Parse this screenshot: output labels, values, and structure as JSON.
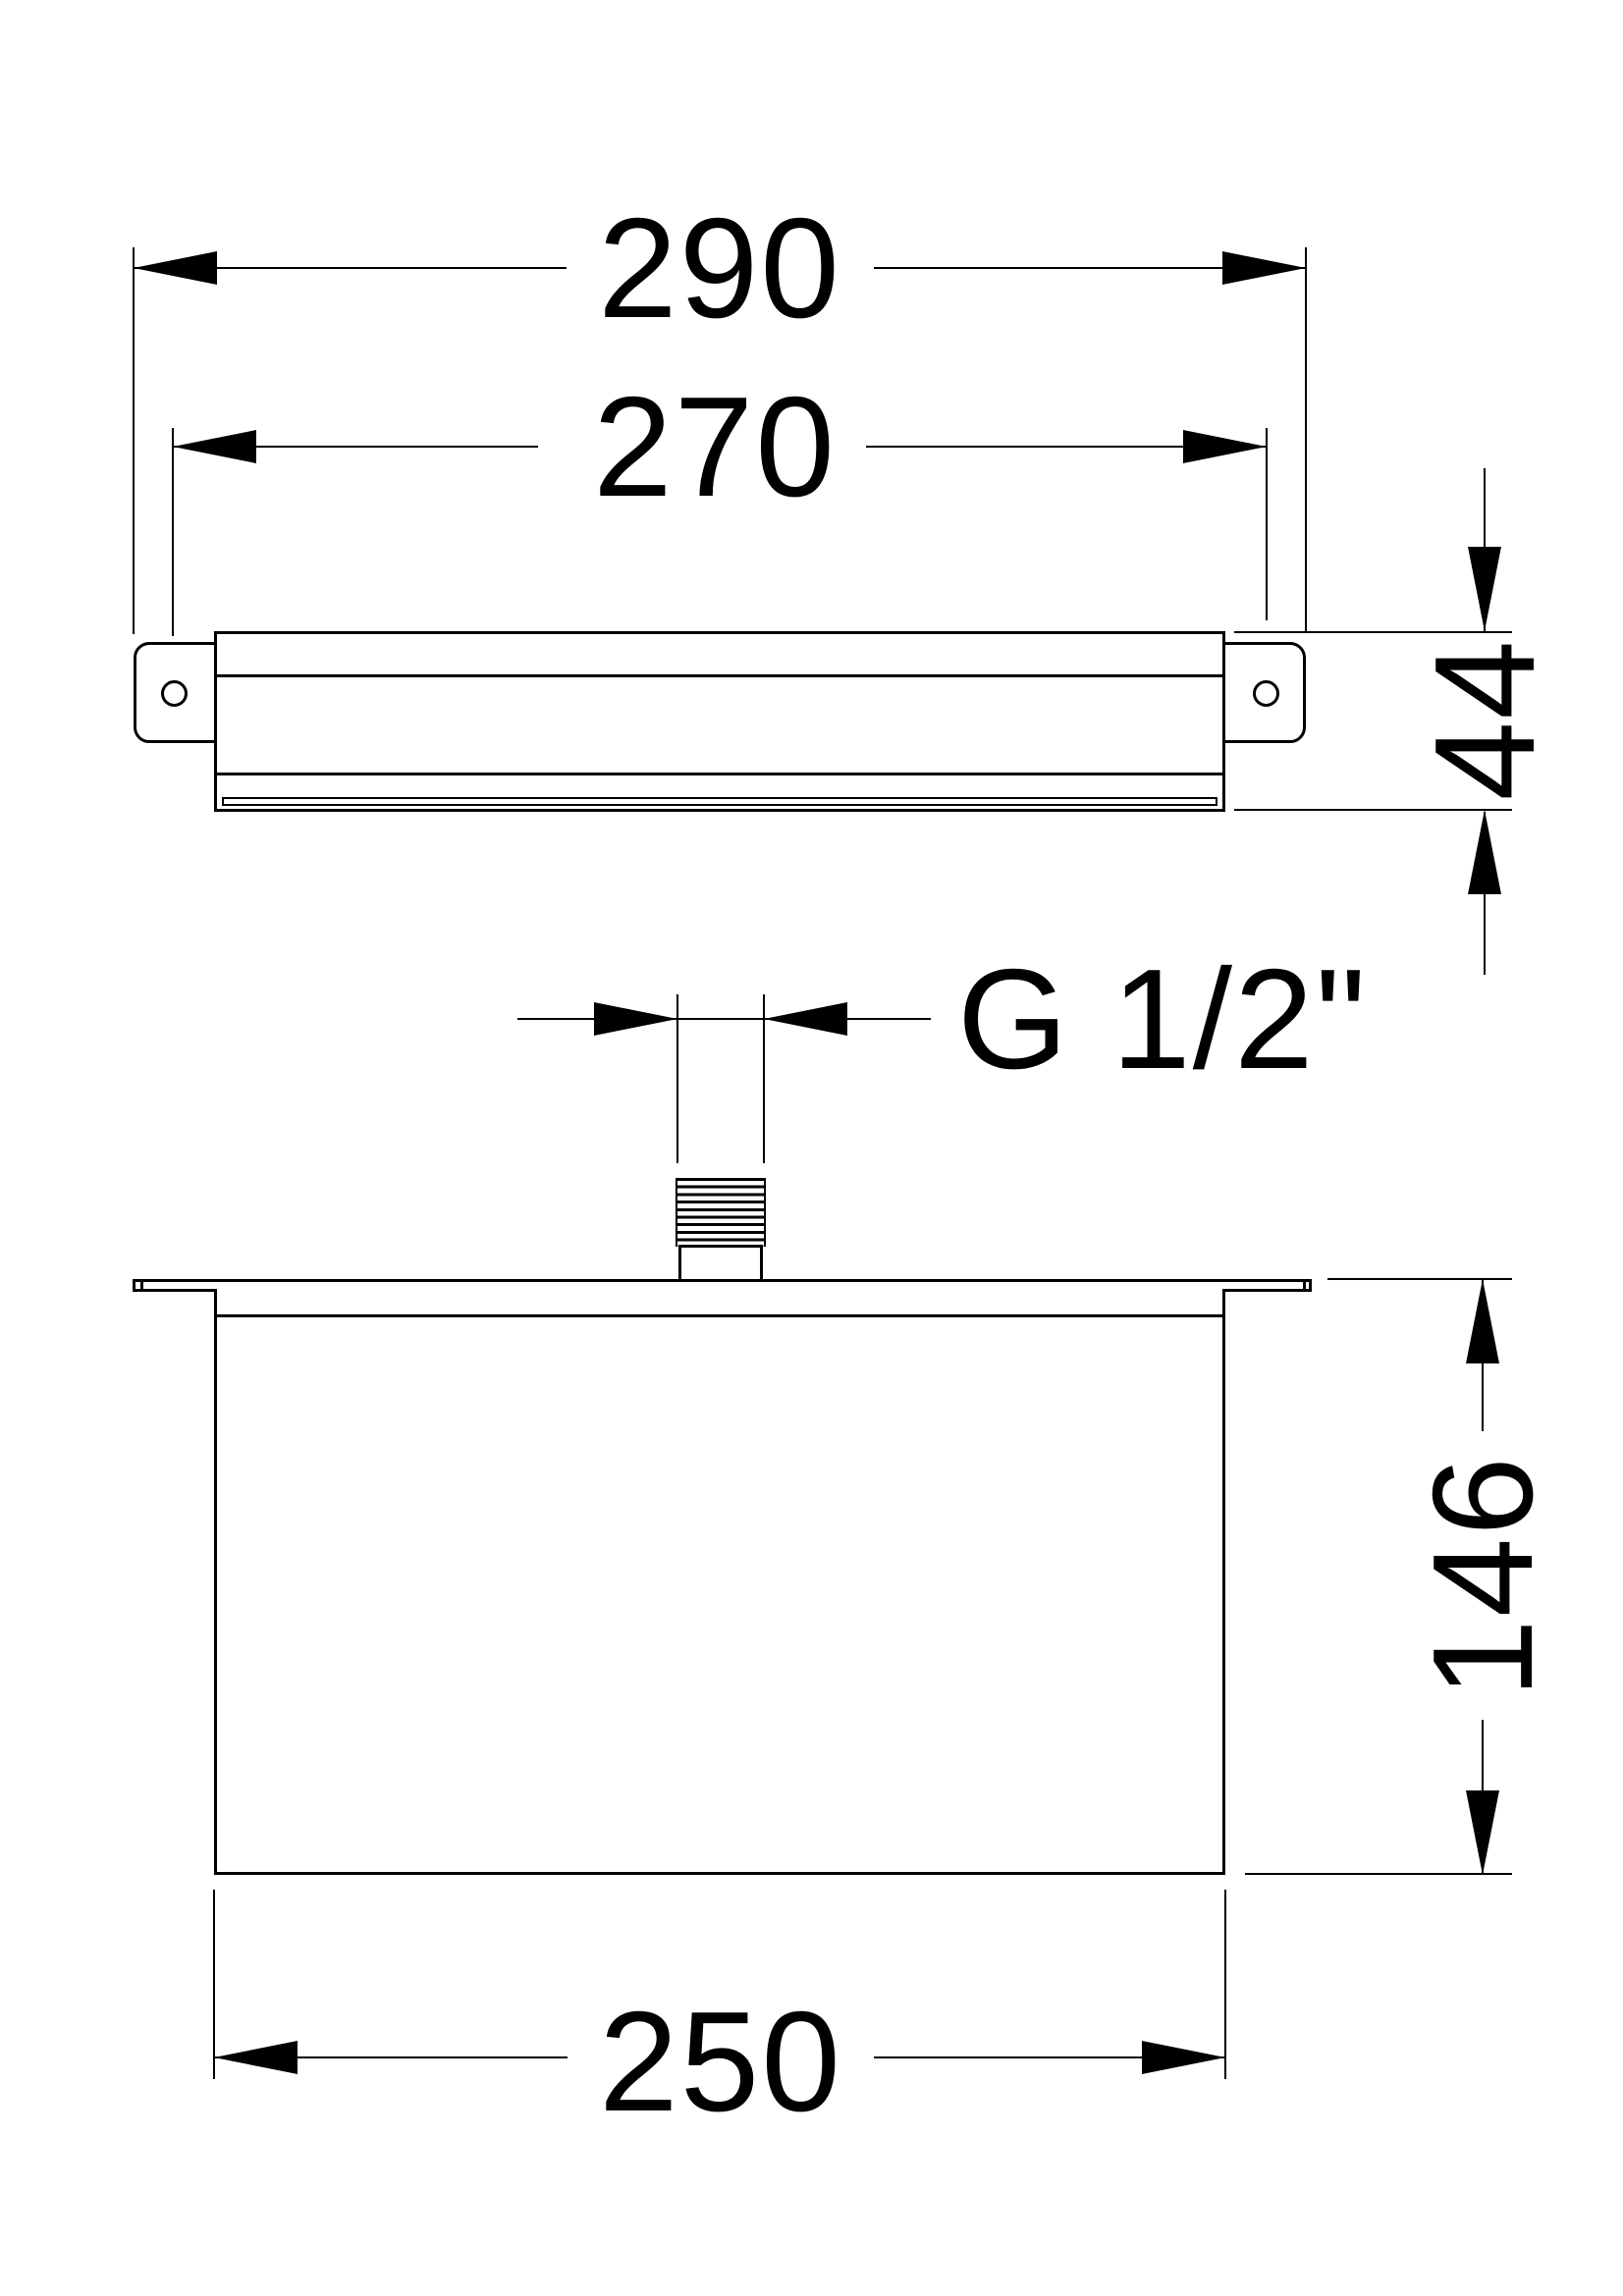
{
  "drawing": {
    "type": "technical-dimension-drawing",
    "background_color": "#ffffff",
    "line_color": "#000000",
    "views": {
      "side_view": "recessed shower head housing with mounting brackets, seen from the side",
      "front_view": "recessed box with ceiling flange and threaded inlet, seen from the front"
    },
    "dimensions": {
      "overall_width": "290",
      "hole_spacing": "270",
      "housing_height": "44",
      "thread_size": "G 1/2\"",
      "recess_depth": "146",
      "body_width": "250"
    }
  }
}
